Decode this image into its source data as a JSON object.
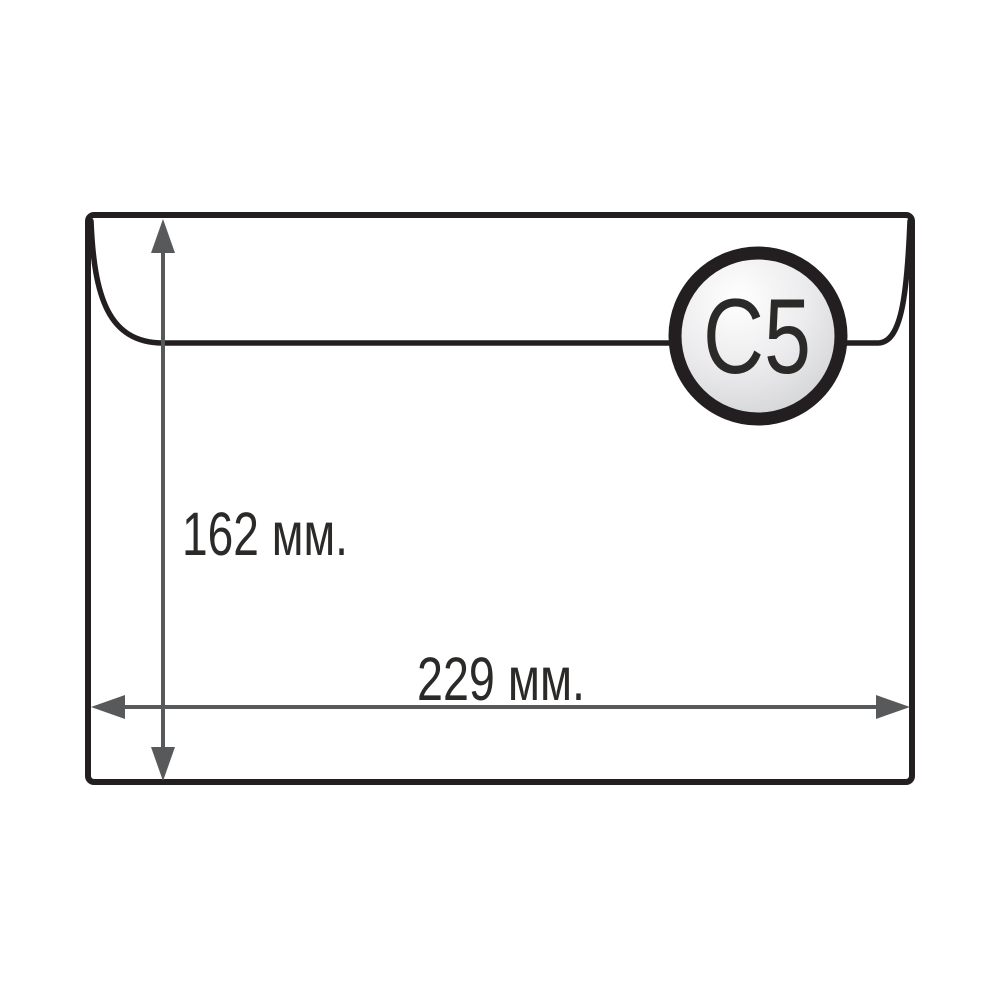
{
  "theme": {
    "background": "#ffffff",
    "outline": "#231f20",
    "arrow": "#58595b",
    "ink": "#2b2a29",
    "badge-light": "#ffffff",
    "badge-mid": "#ebebed",
    "badge-dark": "#c6c7c9"
  },
  "diagram": {
    "badge_label": "C5",
    "height_label": "162 мм.",
    "width_label": "229 мм."
  }
}
